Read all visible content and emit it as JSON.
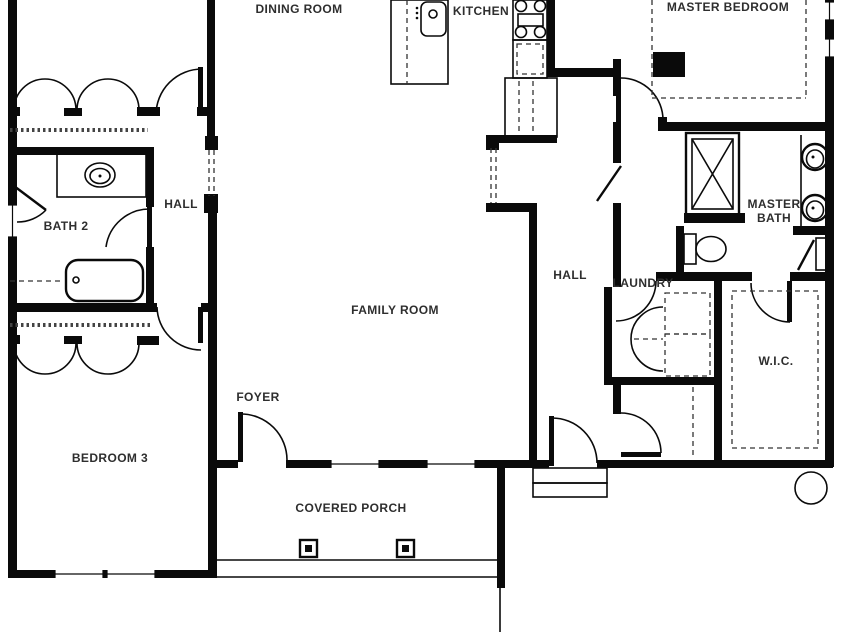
{
  "page": {
    "type": "floor-plan",
    "background_color": "#ffffff",
    "wall_color": "#0a0a0a",
    "label_color": "#2e2e2e"
  },
  "labels": {
    "dining_room": "DINING ROOM",
    "kitchen": "KITCHEN",
    "master_bedroom": "MASTER BEDROOM",
    "hall_left": "HALL",
    "bath2": "BATH 2",
    "family_room": "FAMILY ROOM",
    "hall_right": "HALL",
    "laundry": "LAUNDRY",
    "master_bath_line1": "MASTER",
    "master_bath_line2": "BATH",
    "wic": "W.I.C.",
    "foyer": "FOYER",
    "bedroom3": "BEDROOM 3",
    "covered_porch": "COVERED PORCH"
  },
  "fixtures": [
    "kitchen-island-sink",
    "range",
    "dishwasher",
    "refrigerator",
    "bath2-vanity-sink",
    "bathtub",
    "toilet",
    "shower",
    "master-vanity-double-sinks",
    "washer-dryer",
    "closet-shelving",
    "porch-posts",
    "entry-doors",
    "windows"
  ]
}
